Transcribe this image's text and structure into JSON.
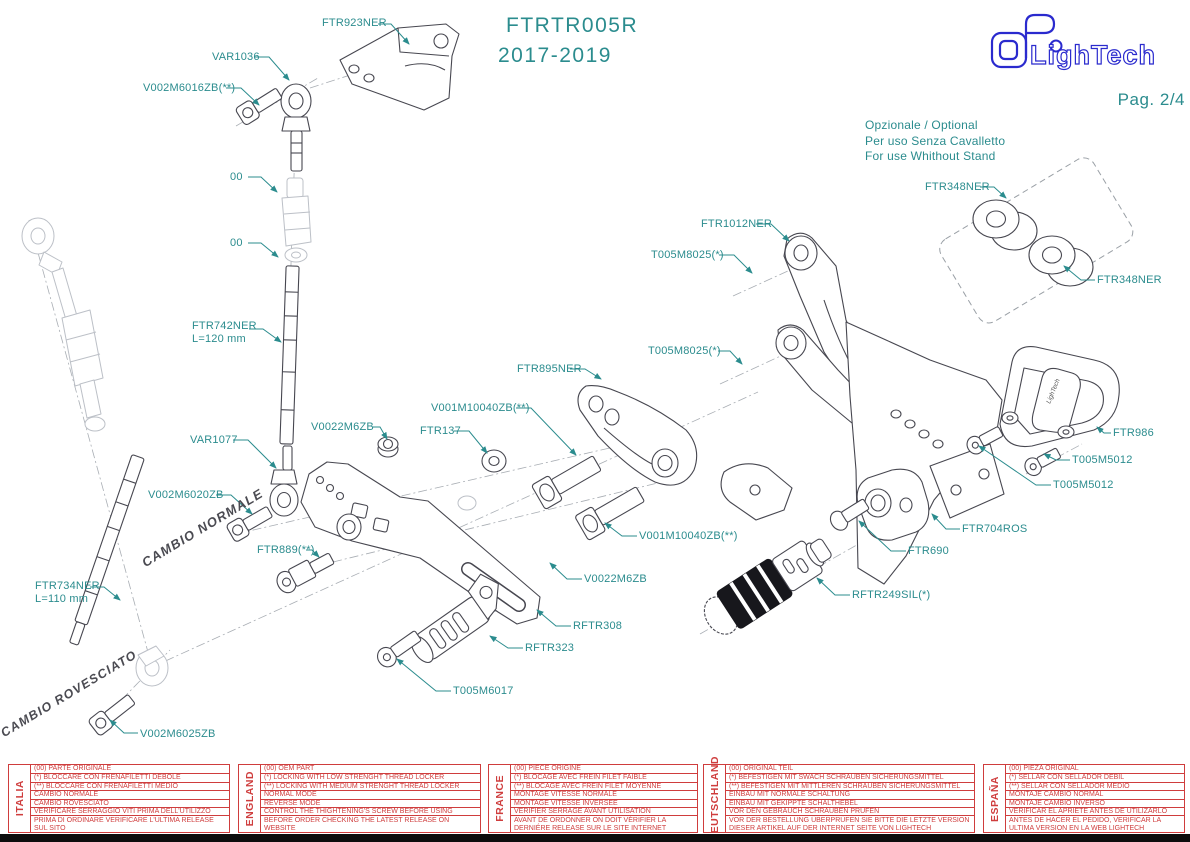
{
  "header": {
    "model": "FTRTR005R",
    "years": "2017-2019",
    "brand": "LighTech",
    "page": "Pag. 2/4"
  },
  "optional_note": {
    "lines": [
      "Opzionale / Optional",
      "Per uso Senza Cavalletto",
      "For use Whithout Stand"
    ]
  },
  "shift_notes": {
    "normal": "CAMBIO NORMALE",
    "reversed": "CAMBIO ROVESCIATO"
  },
  "colors": {
    "label_teal": "#2b8c8e",
    "drawing_gray": "#474750",
    "faint_gray": "#bcc0c7",
    "table_red": "#cf3d3d",
    "logo_blue": "#2a2ace"
  },
  "callouts": [
    {
      "label": "FTR923NER",
      "tx": 322,
      "ty": 17,
      "pts": [
        [
          378,
          24
        ],
        [
          391,
          24
        ],
        [
          409,
          44
        ]
      ]
    },
    {
      "label": "VAR1036",
      "tx": 212,
      "ty": 51,
      "pts": [
        [
          254,
          57
        ],
        [
          269,
          57
        ],
        [
          289,
          80
        ]
      ]
    },
    {
      "label": "V002M6016ZB(**)",
      "tx": 143,
      "ty": 82,
      "pts": [
        [
          226,
          88
        ],
        [
          241,
          88
        ],
        [
          259,
          105
        ]
      ]
    },
    {
      "label": "00",
      "tx": 230,
      "ty": 171,
      "pts": [
        [
          248,
          177
        ],
        [
          261,
          177
        ],
        [
          277,
          192
        ]
      ]
    },
    {
      "label": "00",
      "tx": 230,
      "ty": 237,
      "pts": [
        [
          248,
          243
        ],
        [
          261,
          243
        ],
        [
          278,
          257
        ]
      ]
    },
    {
      "label": "FTR742NER",
      "label2": "L=120 mm",
      "tx": 192,
      "ty": 320,
      "pts": [
        [
          249,
          329
        ],
        [
          263,
          329
        ],
        [
          281,
          342
        ]
      ]
    },
    {
      "label": "VAR1077",
      "tx": 190,
      "ty": 434,
      "pts": [
        [
          233,
          440
        ],
        [
          248,
          440
        ],
        [
          276,
          468
        ]
      ]
    },
    {
      "label": "V0022M6ZB",
      "tx": 311,
      "ty": 421,
      "pts": [
        [
          372,
          427
        ],
        [
          380,
          427
        ],
        [
          387,
          439
        ]
      ]
    },
    {
      "label": "FTR137",
      "tx": 420,
      "ty": 425,
      "pts": [
        [
          454,
          431
        ],
        [
          469,
          431
        ],
        [
          487,
          453
        ]
      ]
    },
    {
      "label": "V001M10040ZB(**)",
      "tx": 431,
      "ty": 402,
      "pts": [
        [
          516,
          408
        ],
        [
          531,
          408
        ],
        [
          576,
          455
        ]
      ]
    },
    {
      "label": "FTR895NER",
      "tx": 517,
      "ty": 363,
      "pts": [
        [
          570,
          369
        ],
        [
          585,
          369
        ],
        [
          601,
          379
        ]
      ]
    },
    {
      "label": "V002M6020ZB",
      "tx": 148,
      "ty": 489,
      "pts": [
        [
          216,
          495
        ],
        [
          231,
          495
        ],
        [
          252,
          514
        ]
      ]
    },
    {
      "label": "FTR889(**)",
      "tx": 257,
      "ty": 544,
      "pts": [
        [
          306,
          550
        ],
        [
          312,
          550
        ],
        [
          319,
          557
        ]
      ]
    },
    {
      "label": "FTR734NER",
      "label2": "L=110 mm",
      "tx": 35,
      "ty": 580,
      "pts": [
        [
          90,
          587
        ],
        [
          104,
          587
        ],
        [
          120,
          600
        ]
      ]
    },
    {
      "label": "V002M6025ZB",
      "tx": 140,
      "ty": 728,
      "pts": [
        [
          138,
          733
        ],
        [
          124,
          733
        ],
        [
          110,
          720
        ]
      ]
    },
    {
      "label": "T005M6017",
      "tx": 453,
      "ty": 685,
      "pts": [
        [
          451,
          691
        ],
        [
          436,
          691
        ],
        [
          397,
          659
        ]
      ]
    },
    {
      "label": "RFTR323",
      "tx": 525,
      "ty": 642,
      "pts": [
        [
          523,
          648
        ],
        [
          508,
          648
        ],
        [
          490,
          636
        ]
      ]
    },
    {
      "label": "RFTR308",
      "tx": 573,
      "ty": 620,
      "pts": [
        [
          571,
          626
        ],
        [
          556,
          626
        ],
        [
          537,
          610
        ]
      ]
    },
    {
      "label": "V0022M6ZB",
      "tx": 584,
      "ty": 573,
      "pts": [
        [
          582,
          579
        ],
        [
          567,
          579
        ],
        [
          550,
          563
        ]
      ]
    },
    {
      "label": "V001M10040ZB(**)",
      "tx": 639,
      "ty": 530,
      "pts": [
        [
          637,
          536
        ],
        [
          622,
          536
        ],
        [
          605,
          523
        ]
      ]
    },
    {
      "label": "FTR1012NER",
      "tx": 701,
      "ty": 218,
      "pts": [
        [
          756,
          224
        ],
        [
          771,
          224
        ],
        [
          789,
          241
        ]
      ]
    },
    {
      "label": "T005M8025(*)",
      "tx": 651,
      "ty": 249,
      "pts": [
        [
          719,
          255
        ],
        [
          734,
          255
        ],
        [
          752,
          273
        ]
      ]
    },
    {
      "label": "T005M8025(*)",
      "tx": 648,
      "ty": 345,
      "pts": [
        [
          718,
          351
        ],
        [
          730,
          351
        ],
        [
          742,
          364
        ]
      ]
    },
    {
      "label": "FTR348NER",
      "tx": 925,
      "ty": 181,
      "pts": [
        [
          980,
          187
        ],
        [
          994,
          187
        ],
        [
          1006,
          198
        ]
      ]
    },
    {
      "label": "FTR348NER",
      "tx": 1097,
      "ty": 274,
      "pts": [
        [
          1095,
          280
        ],
        [
          1081,
          280
        ],
        [
          1064,
          266
        ]
      ]
    },
    {
      "label": "FTR986",
      "tx": 1113,
      "ty": 427,
      "pts": [
        [
          1111,
          433
        ],
        [
          1104,
          433
        ],
        [
          1097,
          427
        ]
      ]
    },
    {
      "label": "T005M5012",
      "tx": 1072,
      "ty": 454,
      "pts": [
        [
          1070,
          460
        ],
        [
          1056,
          460
        ],
        [
          1044,
          454
        ]
      ]
    },
    {
      "label": "T005M5012",
      "tx": 1053,
      "ty": 479,
      "pts": [
        [
          1051,
          485
        ],
        [
          1036,
          485
        ],
        [
          979,
          446
        ]
      ]
    },
    {
      "label": "FTR704ROS",
      "tx": 962,
      "ty": 523,
      "pts": [
        [
          960,
          529
        ],
        [
          946,
          529
        ],
        [
          932,
          514
        ]
      ]
    },
    {
      "label": "FTR690",
      "tx": 908,
      "ty": 545,
      "pts": [
        [
          906,
          551
        ],
        [
          891,
          551
        ],
        [
          859,
          521
        ]
      ]
    },
    {
      "label": "RFTR249SIL(*)",
      "tx": 852,
      "ty": 589,
      "pts": [
        [
          850,
          595
        ],
        [
          835,
          595
        ],
        [
          817,
          578
        ]
      ]
    }
  ],
  "tables": [
    {
      "country": "ITALIA",
      "x": 8,
      "w": 222,
      "rows": [
        "(00) PARTE ORIGINALE",
        "(*)  BLOCCARE CON FRENAFILETTI DEBOLE",
        "(**) BLOCCARE CON FRENAFILETTI MEDIO",
        "CAMBIO NORMALE",
        "CAMBIO ROVESCIATO",
        "VERIFICARE SERRAGGIO VITI PRIMA DELL'UTILIZZO",
        "PRIMA DI ORDINARE VERIFICARE L'ULTIMA RELEASE SUL SITO"
      ]
    },
    {
      "country": "ENGLAND",
      "x": 238,
      "w": 243,
      "rows": [
        "(00) OEM PART",
        "(*)  LOCKING WITH LOW STRENGHT THREAD LOCKER",
        "(**) LOCKING WITH MEDIUM STRENGHT THREAD LOCKER",
        "NORMAL MODE",
        "REVERSE MODE",
        "CONTROL THE THIGHTENING'S SCREW BEFORE USING",
        "BEFORE ORDER CHECKING THE LATEST RELEASE ON WEBSITE"
      ]
    },
    {
      "country": "FRANCE",
      "x": 488,
      "w": 210,
      "rows": [
        "(00) PIECE ORIGINE",
        "(*)  BLOCAGE AVEC FREIN FILET FAIBLE",
        "(**) BLOCAGE AVEC FREIN FILET MOYENNE",
        "MONTAGE VITESSE NORMALE",
        "MONTAGE VITESSE INVERSEE",
        "VERIFIER SERRAGE AVANT UTILISATION",
        "AVANT DE ORDONNER ON DOIT VÉRIFIER LA DERNIÉRE RELEASE SUR LE SITE INTERNET"
      ]
    },
    {
      "country": "DEUTSCHLAND",
      "x": 703,
      "w": 272,
      "rows": [
        "(00) ORIGINAL TEIL",
        "(*)  BEFESTIGEN MIT SWACH SCHRAUBEN SICHERUNGSMITTEL",
        "(**) BEFESTIGEN MIT MITTLEREN SCHRAUBEN SICHERUNGSMITTEL",
        "EINBAU MIT NORMALE SCHALTUNG",
        "EINBAU MIT GEKIPPTE SCHALTHEBEL",
        "VOR DEN GEBRAUCH SCHRAUBEN PRÜFEN",
        "VOR DER BESTELLUNG ÜBERPRÜFEN SIE BITTE DIE LETZTE VERSION DIESER ARTIKEL AUF DER INTERNET SEITE VON LIGHTECH"
      ]
    },
    {
      "country": "ESPAÑA",
      "x": 983,
      "w": 202,
      "rows": [
        "(00) PIEZA ORIGINAL",
        "(*)  SELLAR CON SELLADOR DEBIL",
        "(**) SELLAR CON SELLADOR MEDIO",
        "MONTAJE  CAMBIO NORMAL",
        "MONTAJE CAMBIO INVERSO",
        "VERIFICAR EL APRIETE ANTES DE UTILIZARLO",
        "ANTES DE HACER EL PEDIDO, VERIFICAR LA ULTIMA VERSION EN LA WEB LIGHTECH"
      ]
    }
  ]
}
